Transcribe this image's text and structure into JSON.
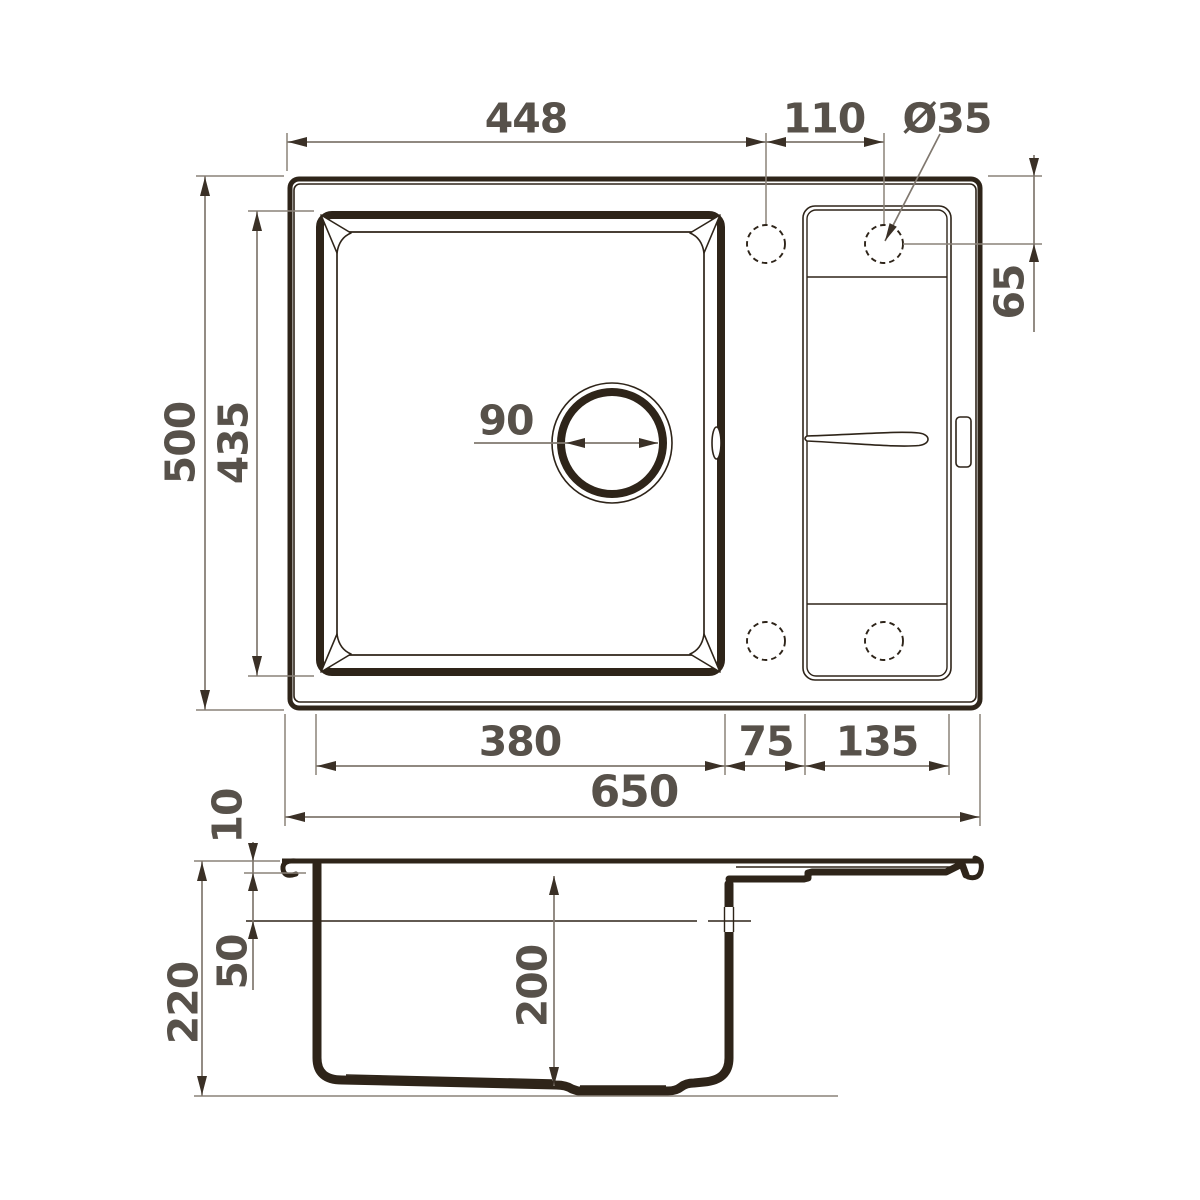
{
  "drawing": {
    "title": "Kitchen sink technical drawing, top view and section view",
    "colors": {
      "object_line": "#2e2419",
      "dimension_line": "#80786f",
      "dimension_text": "#57514a",
      "background": "#ffffff"
    },
    "top_view": {
      "dims": {
        "left_edge_to_hole1": "448",
        "hole_spacing": "110",
        "hole_diameter": "Ø35",
        "hole_offset_from_top": "65",
        "overall_depth": "500",
        "bowl_outer_depth": "435",
        "drain_diameter": "90",
        "bowl_width": "380",
        "gap_width": "75",
        "drainboard_width": "135",
        "overall_width": "650"
      }
    },
    "side_view": {
      "dims": {
        "rim_thickness": "10",
        "overall_height": "220",
        "ledge_depth": "50",
        "bowl_depth": "200"
      }
    }
  }
}
